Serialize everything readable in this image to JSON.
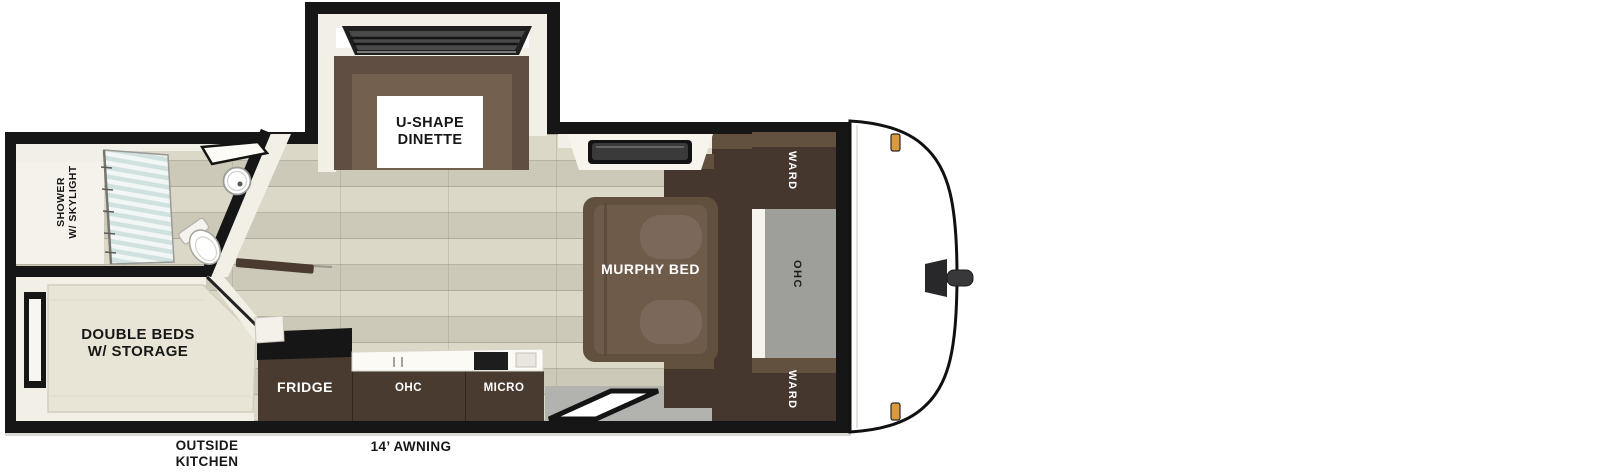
{
  "floorplan": {
    "labels": {
      "dinette": [
        "U-SHAPE",
        "DINETTE"
      ],
      "shower": [
        "SHOWER",
        "W/ SKYLIGHT"
      ],
      "double_beds": [
        "DOUBLE BEDS",
        "W/ STORAGE"
      ],
      "murphy_bed": "MURPHY BED",
      "ward_top": "WARD",
      "ward_bottom": "WARD",
      "ohc_right": "OHC",
      "fridge": "FRIDGE",
      "ohc_kitchen": "OHC",
      "micro": "MICRO",
      "outside_kitchen": [
        "OUTSIDE",
        "KITCHEN"
      ],
      "awning": "14’ AWNING"
    },
    "colors": {
      "wall": "#161616",
      "wood_floor": "#d8d4c2",
      "plank_line": "#928e7c",
      "gray_floor": "#b2b2ae",
      "gray_panel": "#9e9e9a",
      "cabinet_dark": "#4a3b31",
      "cabinet_top_face": "#63513f",
      "sofa_brown": "#5f4e41",
      "cushion_brown": "#74604f",
      "mattress_brown": "#6e5b4a",
      "bed_beige": "#e9e5d6",
      "trim_white": "#f2efe6",
      "glass_stripe": "#cfe2e0",
      "marker_light": "#d99a3f",
      "text_dark": "#171717",
      "text_light": "#ffffff"
    }
  }
}
